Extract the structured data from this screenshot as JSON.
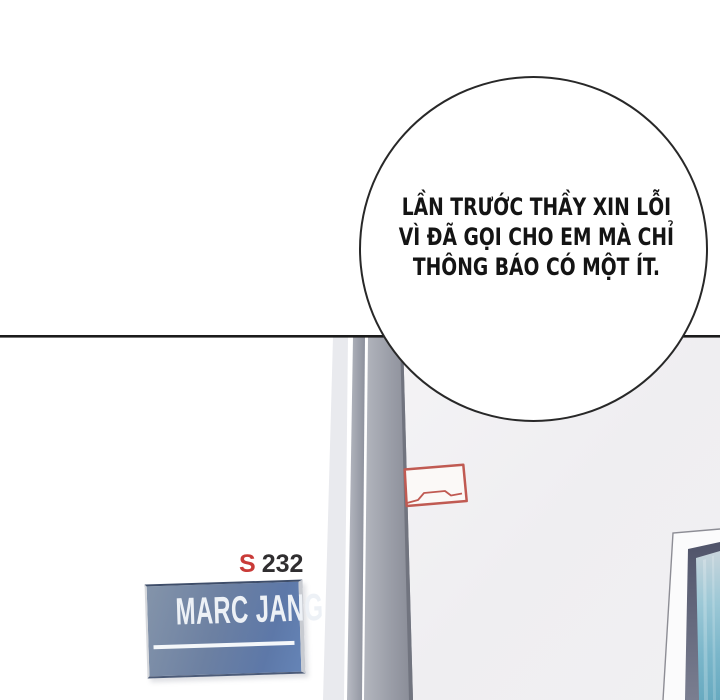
{
  "speech_bubble": {
    "lines": [
      "LẦN TRƯỚC THẦY XIN LỖI",
      "VÌ ĐÃ GỌI CHO EM MÀ CHỈ",
      "THÔNG BÁO CÓ MỘT ÍT."
    ]
  },
  "door_scene": {
    "room_code": {
      "letter": "S",
      "number": "232"
    },
    "name_plate": {
      "name": "MARC JANG"
    }
  },
  "colors": {
    "panel_line": "#1b1b1b",
    "bubble_outline": "#282828",
    "speech_text": "#141414",
    "room_code_letter": "#c93b38",
    "room_code_number": "#302e30",
    "name_plate_blue": "#64789e",
    "name_plate_text": "#edf1f6",
    "card_holder_red": "#c05a52",
    "door_panel_gray": "#f1f0f2",
    "frame_strip_gray": "#9a9da7",
    "window_frame_slate": "#60647a",
    "window_glass_teal": "#7ab6ca"
  }
}
